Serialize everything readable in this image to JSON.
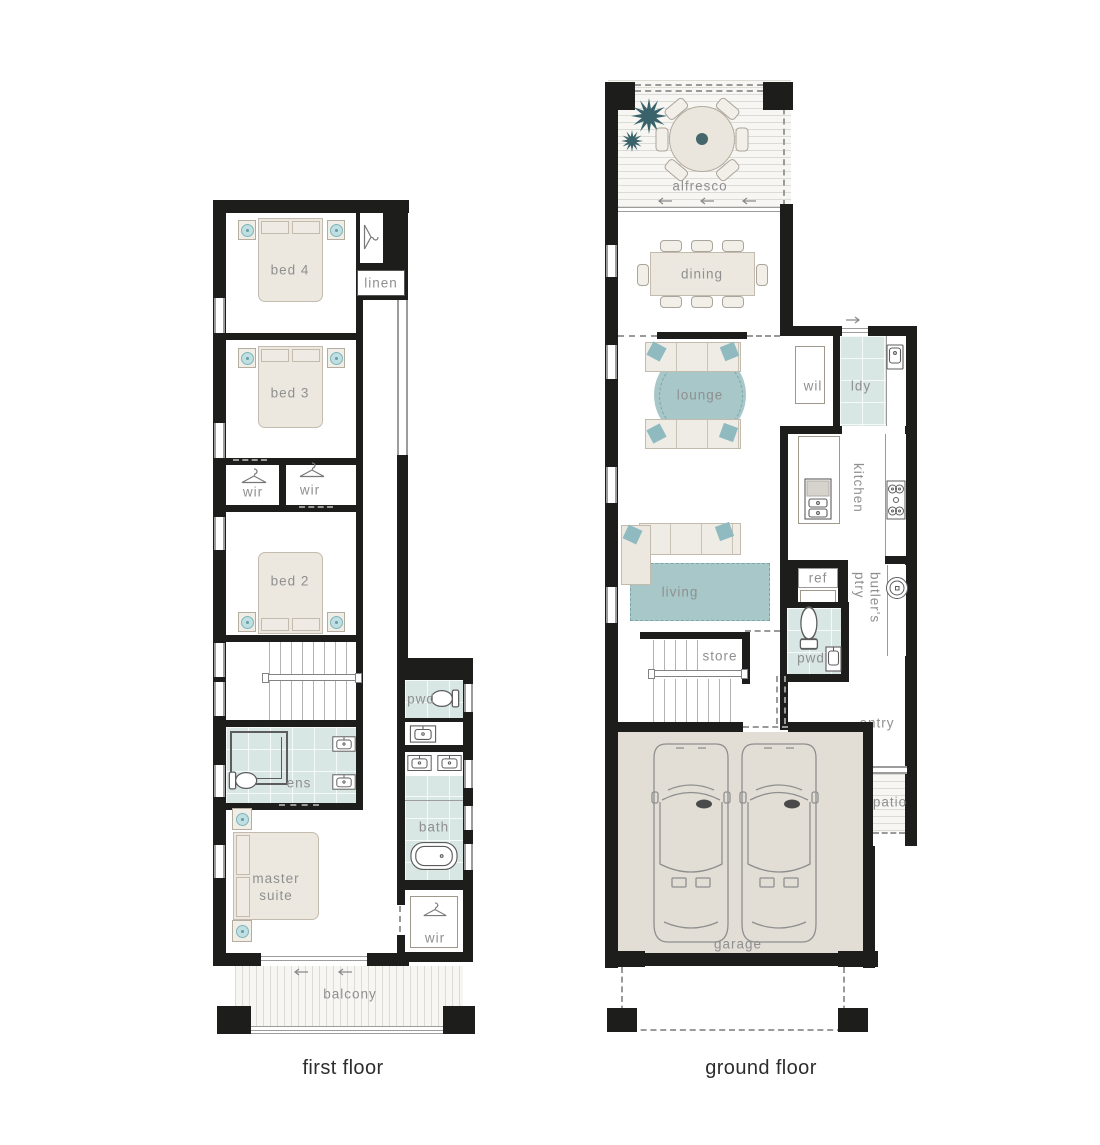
{
  "captions": {
    "first": "first floor",
    "ground": "ground floor"
  },
  "first_floor": {
    "bed4": "bed 4",
    "linen": "linen",
    "bed3": "bed 3",
    "wir_a": "wir",
    "wir_b": "wir",
    "bed2": "bed 2",
    "pwd": "pwd",
    "ens": "ens",
    "bath": "bath",
    "master": "master suite",
    "wir_c": "wir",
    "balcony": "balcony"
  },
  "ground_floor": {
    "alfresco": "alfresco",
    "dining": "dining",
    "lounge": "lounge",
    "wil": "wil",
    "ldy": "ldy",
    "kitchen": "kitchen",
    "living": "living",
    "ref": "ref",
    "butlers": "butler's ptry",
    "pwd": "pwd",
    "store": "store",
    "entry": "entry",
    "patio": "patio",
    "garage": "garage"
  },
  "colors": {
    "wall": "#1d1d1b",
    "tile": "#d8e6e4",
    "rug": "#a7c7c8",
    "pillow": "#8fbac0",
    "furniture": "#ece8e0",
    "garage_floor": "#e2ded6",
    "plant": "#39626a",
    "label": "#8f8f8f",
    "caption": "#2d2d2d"
  }
}
